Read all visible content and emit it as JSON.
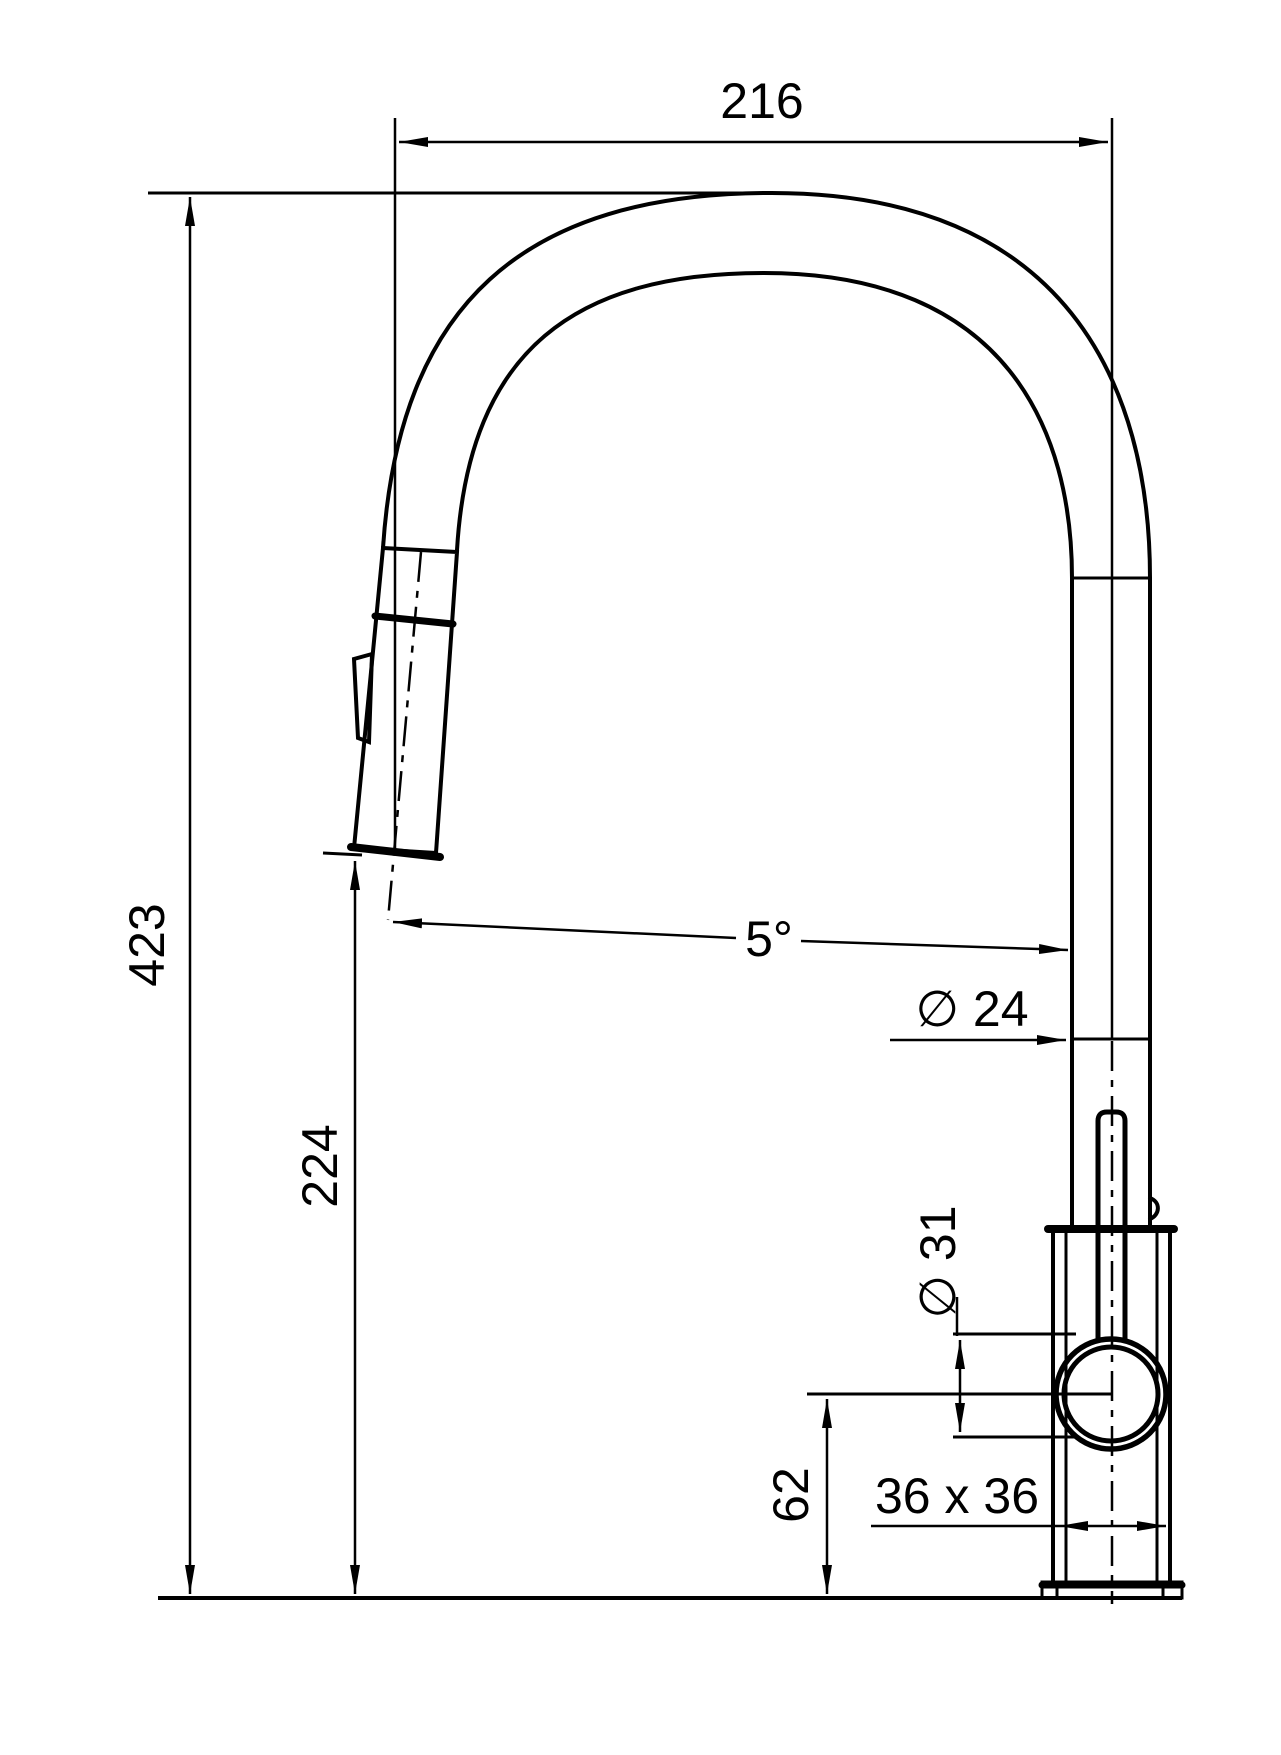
{
  "drawing": {
    "title": "faucet-dimension-drawing",
    "colors": {
      "ink": "#000000",
      "background": "#ffffff"
    },
    "labels": {
      "top_width": "216",
      "overall_height": "423",
      "outlet_height": "224",
      "spout_angle": "5°",
      "pipe_diameter": "∅ 24",
      "joint_diameter": "∅ 31",
      "joint_center_height": "62",
      "base_size": "36 x 36"
    }
  }
}
